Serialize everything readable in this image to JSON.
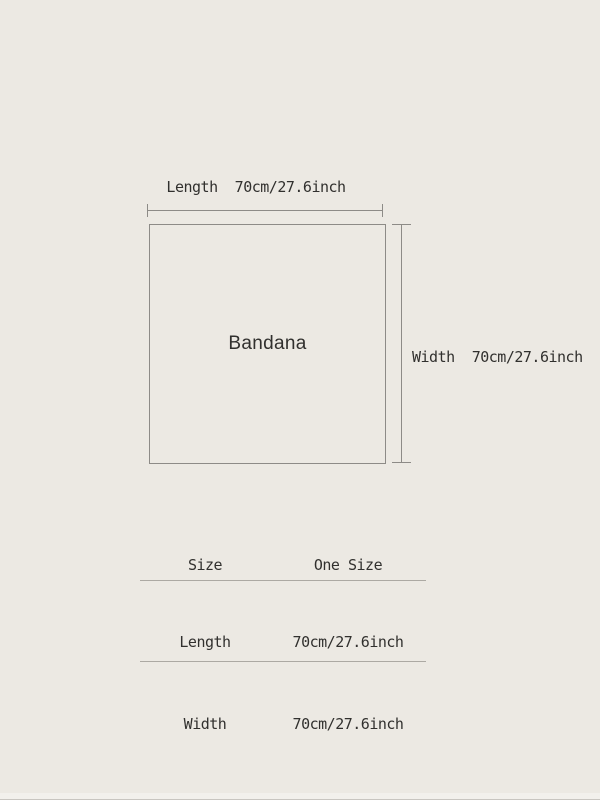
{
  "colors": {
    "background": "#ECE9E3",
    "line": "#8D8B87",
    "table_rule": "#ACA9A3",
    "text": "#31302E"
  },
  "diagram": {
    "item_label": "Bandana",
    "length_label": "Length  70cm/27.6inch",
    "width_label": "Width  70cm/27.6inch"
  },
  "size_table": {
    "header": {
      "size_col": "Size",
      "value_col": "One Size"
    },
    "rows": [
      {
        "label": "Length",
        "value": "70cm/27.6inch"
      },
      {
        "label": "Width",
        "value": "70cm/27.6inch"
      }
    ]
  }
}
